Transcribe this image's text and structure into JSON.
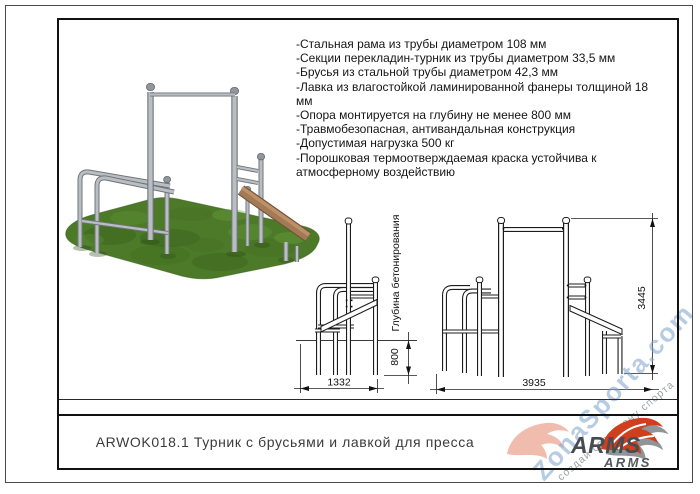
{
  "sheet": {
    "title": "ARWOK018.1 Турник с брусьями и лавкой для пресса",
    "specs": [
      "-Стальная рама из трубы диаметром 108 мм",
      "-Секции перекладин-турник из трубы диаметром 33,5 мм",
      "-Брусья из стальной трубы диаметром 42,3 мм",
      "-Лавка из влагостойкой ламинированной фанеры толщиной 18 мм",
      "-Опора монтируется на глубину не менее 800 мм",
      "-Травмобезопасная, антивандальная конструкция",
      "-Допустимая нагрузка 500 кг",
      "-Порошковая термоотверждаемая краска устойчива к атмосферному воздействию"
    ],
    "drawings": {
      "side_view": {
        "width_mm": "1332",
        "depth_mm": "800",
        "depth_label": "Глубина бетонирования"
      },
      "front_view": {
        "width_mm": "3935",
        "height_mm": "3445"
      }
    },
    "logo": {
      "name": "ARMS",
      "name_small": "ARMS"
    },
    "watermark": {
      "site": "ZonaSporta.com",
      "slogan": "создай свою зону спорта"
    },
    "colors": {
      "accent_red": "#cf3f1e",
      "logo_gray": "#90959a",
      "watermark_blue": "#7ea3cd",
      "grass_green": "#4d7a29",
      "metal_gray": "#b9bec3",
      "bench_brown": "#a27a55"
    }
  }
}
